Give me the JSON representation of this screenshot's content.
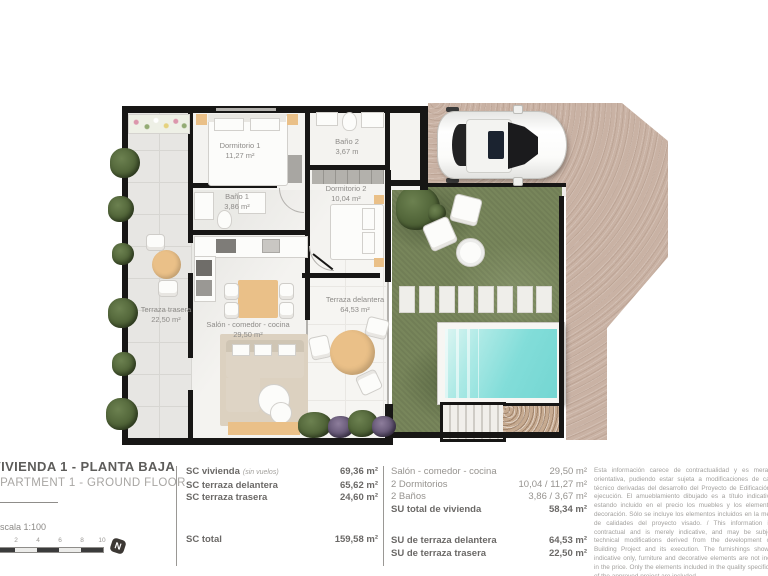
{
  "plan": {
    "rooms": [
      {
        "name": "Dormitorio 1",
        "area": "11,27 m²"
      },
      {
        "name": "Baño 2",
        "area": "3,67 m"
      },
      {
        "name": "Baño 1",
        "area": "3,86 m²"
      },
      {
        "name": "Dormitorio 2",
        "area": "10,04 m²"
      },
      {
        "name": "Terraza trasera",
        "area": "22,50 m²"
      },
      {
        "name": "Salón - comedor - cocina",
        "area": "29,50 m²"
      },
      {
        "name": "Terraza delantera",
        "area": "64,53 m²"
      }
    ]
  },
  "title_block": {
    "title_es": "VIVIENDA 1 - PLANTA BAJA",
    "title_en": "APARTMENT 1 - GROUND FLOOR",
    "scale_label": "Escala  1:100",
    "scale_ticks": [
      "0",
      "2",
      "4",
      "6",
      "8",
      "10"
    ],
    "north": "N"
  },
  "sc_table": {
    "rows": [
      {
        "label": "SC vivienda",
        "note": "(sin vuelos)",
        "value": "69,36 m²"
      },
      {
        "label": "SC terraza delantera",
        "note": "",
        "value": "65,62 m²"
      },
      {
        "label": "SC terraza trasera",
        "note": "",
        "value": "24,60 m²"
      }
    ],
    "total_label": "SC total",
    "total_value": "159,58 m²"
  },
  "su_table": {
    "rows": [
      {
        "label": "Salón - comedor - cocina",
        "value": "29,50 m²"
      },
      {
        "label": "2 Dormitorios",
        "value": "10,04 / 11,27 m²"
      },
      {
        "label": "2 Baños",
        "value": "3,86 / 3,67 m²"
      },
      {
        "label": "SU total de vivienda",
        "value": "58,34 m²"
      }
    ],
    "terrace_rows": [
      {
        "label": "SU de terraza delantera",
        "value": "64,53 m²"
      },
      {
        "label": "SU de terraza trasera",
        "value": "22,50 m²"
      }
    ]
  },
  "disclaimer": "Esta información carece de contractualidad y es meramente orientativa, pudiendo estar sujeta a modificaciones de carácter técnico derivadas del desarrollo del Proyecto de Edificación y su ejecución. El amueblamiento dibujado es a título indicativo, no estando incluido en el precio los muebles y los elementos de decoración. Sólo se incluye los elementos incluidos en la memoria de calidades del proyecto visado. / This information is not contractual and is merely indicative, and may be subject to technical modifications derived from the development of the Building Project and its execution. The furnishings shown are indicative only, furniture and decorative elements are not included in the price. Only the elements included in the quality specifications of the approved project are included.",
  "colors": {
    "driveway": "#c9b2a4",
    "grass": "#78865b",
    "pool_water": "#7fdcd8",
    "wall": "#171615",
    "wood_accent": "#eac088"
  }
}
